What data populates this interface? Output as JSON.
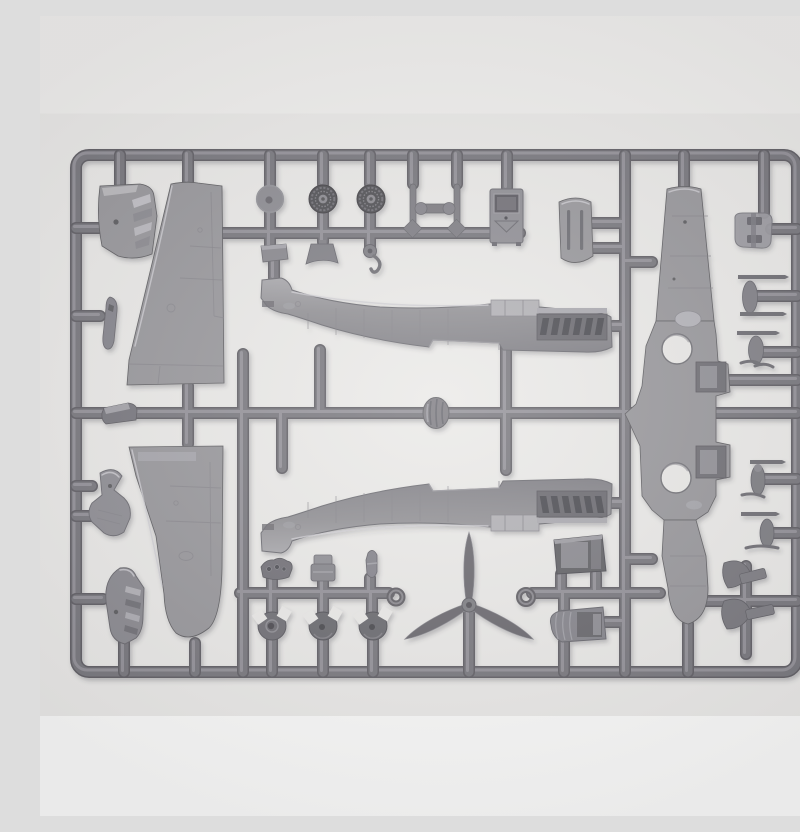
{
  "scene": {
    "type": "photograph",
    "description": "Gray plastic injection-moulded sprue (parts frame) of a WWII single-engine fighter aircraft scale model kit, photographed flat on a light background",
    "manufacturer_logo": "ICM"
  },
  "colors": {
    "background_top": "#f0efed",
    "background_main": "#eae9e7",
    "background_bottom": "#fafaf9",
    "runner_dark": "#5e5d63",
    "runner": "#77767c",
    "runner_highlight": "#9b9aa0",
    "part": "#97969a",
    "part_light": "#bcbbbf",
    "part_dark": "#5c5b5f",
    "wheel_dark": "#4e4d51"
  },
  "parts": [
    {
      "id": "cowling-louvre-panel",
      "location": "top-left"
    },
    {
      "id": "wing-upper-panel-a",
      "location": "upper-left, tip up"
    },
    {
      "id": "spinner-backplate-disc",
      "location": "top row"
    },
    {
      "id": "main-wheel-1",
      "location": "top row"
    },
    {
      "id": "main-wheel-2",
      "location": "top row"
    },
    {
      "id": "landing-gear-struts-pair",
      "location": "top row"
    },
    {
      "id": "radio-box",
      "location": "top row"
    },
    {
      "id": "engine-cowl-top",
      "location": "top row"
    },
    {
      "id": "access-plate",
      "location": "below top row"
    },
    {
      "id": "bell-mount",
      "location": "below top row"
    },
    {
      "id": "hook-ring",
      "location": "below top row"
    },
    {
      "id": "fuselage-half-right",
      "location": "center, nose right"
    },
    {
      "id": "fuselage-half-left",
      "location": "center lower, mirrored"
    },
    {
      "id": "spinner-oval",
      "location": "middle rail"
    },
    {
      "id": "headrest-hood",
      "location": "middle rail left"
    },
    {
      "id": "aileron-blade",
      "location": "left column"
    },
    {
      "id": "wing-root-fairing",
      "location": "left column"
    },
    {
      "id": "louvred-cowl-side",
      "location": "lower-left"
    },
    {
      "id": "wing-upper-panel-b",
      "location": "lower-left, tip down"
    },
    {
      "id": "one-piece-lower-wing",
      "location": "right column, vertical"
    },
    {
      "id": "wheel-well-openings",
      "location": "lower wing centre"
    },
    {
      "id": "pilot-seat-frame",
      "location": "top-right"
    },
    {
      "id": "tail-strut-antenna-1",
      "location": "right column"
    },
    {
      "id": "tail-strut-antenna-2",
      "location": "right column"
    },
    {
      "id": "gear-leg-small-1",
      "location": "right column lower"
    },
    {
      "id": "gear-leg-small-2",
      "location": "right column lower"
    },
    {
      "id": "elevator-paddle-pair",
      "location": "bottom-right"
    },
    {
      "id": "instrument-panel-mini",
      "location": "bottom row"
    },
    {
      "id": "seat-pan",
      "location": "bottom row"
    },
    {
      "id": "small-fin",
      "location": "bottom row"
    },
    {
      "id": "spinner-half-1",
      "location": "bottom row"
    },
    {
      "id": "spinner-half-2",
      "location": "bottom row"
    },
    {
      "id": "spinner-half-3",
      "location": "bottom row"
    },
    {
      "id": "three-blade-propeller",
      "location": "bottom centre"
    },
    {
      "id": "radiator-housing-open",
      "location": "bottom centre-right"
    },
    {
      "id": "radiator-housing-teardrop",
      "location": "bottom centre-right"
    },
    {
      "id": "sight-ring-1",
      "location": "bottom rail"
    },
    {
      "id": "sight-ring-2",
      "location": "bottom rail"
    },
    {
      "id": "icm-logo-tab",
      "location": "right edge"
    }
  ]
}
